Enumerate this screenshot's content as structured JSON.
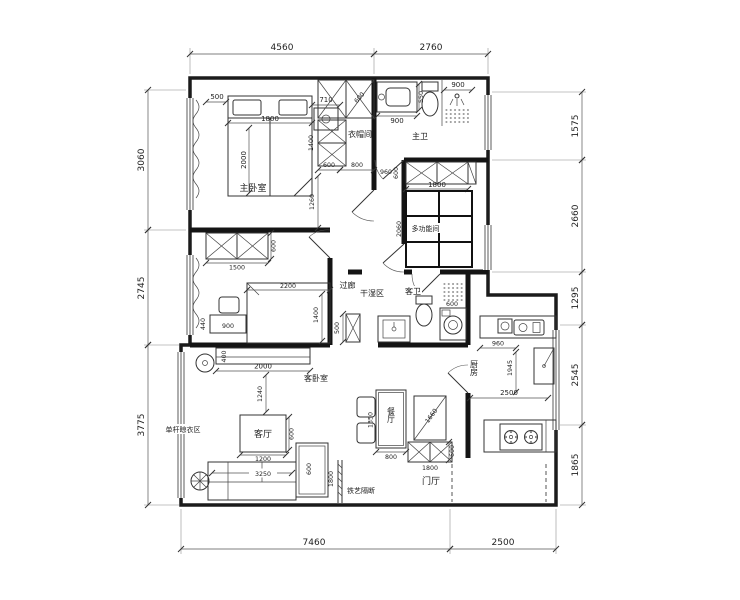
{
  "canvas": {
    "bg": "#ffffff",
    "ink": "#1f1f1f"
  },
  "rooms": {
    "master_bedroom": "主卧室",
    "cloakroom": "衣帽间",
    "master_bath": "主卫",
    "multi_function": "多功能间",
    "corridor": "过廊",
    "dry_wet_zone": "干湿区",
    "guest_bath": "客卫",
    "kitchen": "厨房",
    "dining": "餐厅",
    "living": "客厅",
    "guest_bedroom": "客卧室",
    "drying_zone": "单杆晾衣区",
    "iron_partition": "铁艺隔断",
    "foyer": "门厅"
  },
  "dims": {
    "top": [
      "4560",
      "2760"
    ],
    "bottom": [
      "7460",
      "2500"
    ],
    "left": [
      "3060",
      "2745",
      "3775"
    ],
    "right": [
      "1575",
      "2660",
      "1295",
      "2545",
      "1865"
    ],
    "master": {
      "window": "500",
      "bed_width": "1800",
      "bed_length": "2000",
      "nightstand": "710",
      "wardrobe_diag": "600",
      "column_height": "1400",
      "seg_a": "600",
      "seg_b": "800",
      "wall": "1260"
    },
    "master_bath": {
      "basin": "900",
      "basin_depth": "550",
      "shower": "900"
    },
    "multi": {
      "niche": "960",
      "depth": "600",
      "cabinet": "1800",
      "tatami": "2060"
    },
    "guest_bed": {
      "wardrobe": "1500",
      "wardrobe_depth": "600",
      "bed_length": "2200",
      "bed_width": "1400",
      "desk": "900",
      "side": "440"
    },
    "guest_bath": {
      "cabinet": "500",
      "washer": "600"
    },
    "kitchen": {
      "worktop": "960",
      "depth": "1945",
      "width": "2500"
    },
    "dining": {
      "table": "1350",
      "width": "800",
      "cabinet": "1660",
      "side": "600",
      "shoe": "1800"
    },
    "living": {
      "tv_depth": "400",
      "tv_width": "2000",
      "gap": "1240",
      "table": "1200",
      "table_depth": "600",
      "sofa": "3250",
      "chaise": "600",
      "partition": "1800"
    }
  }
}
